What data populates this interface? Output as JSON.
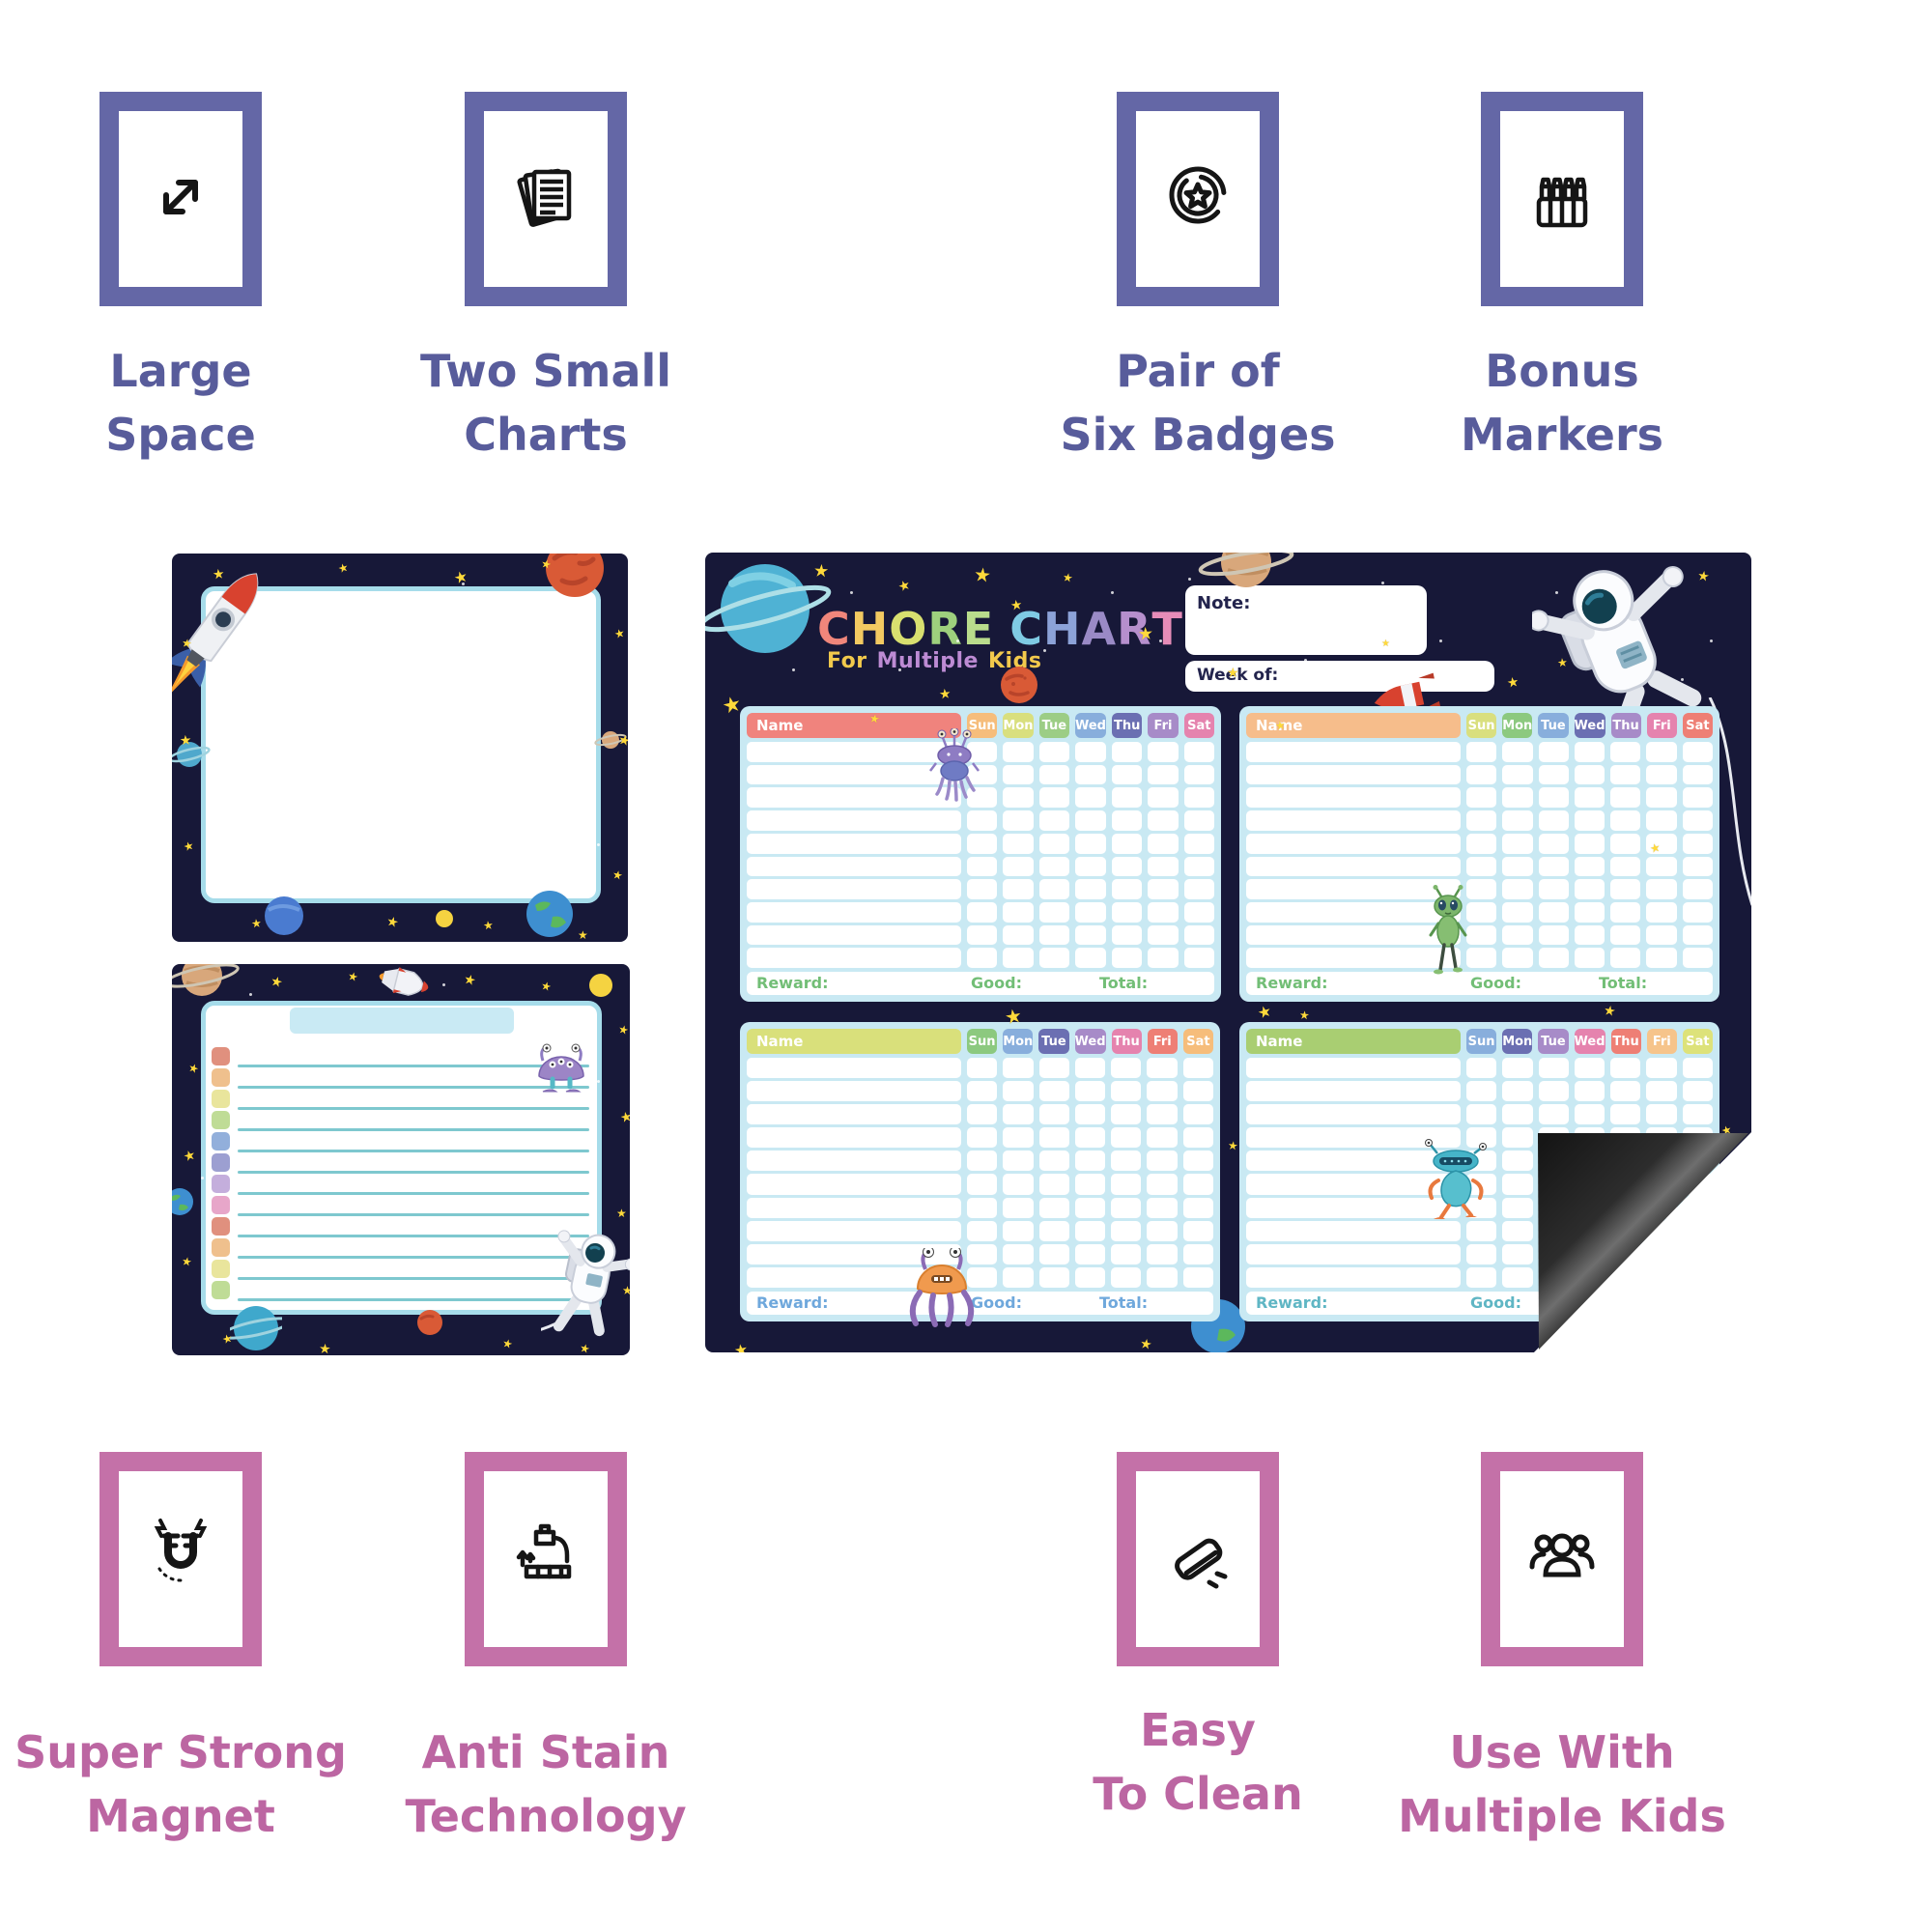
{
  "features_top": {
    "border_color": "#6467A6",
    "text_color": "#585C9B",
    "items": [
      {
        "icon": "expand-icon",
        "line1": "Large",
        "line2": "Space"
      },
      {
        "icon": "documents-icon",
        "line1": "Two Small",
        "line2": "Charts"
      },
      {
        "icon": "badge-icon",
        "line1": "Pair of",
        "line2": "Six Badges"
      },
      {
        "icon": "markers-icon",
        "line1": "Bonus",
        "line2": "Markers"
      }
    ]
  },
  "features_bottom": {
    "border_color": "#C471A8",
    "text_color": "#BC66A2",
    "items": [
      {
        "icon": "magnet-icon",
        "line1": "Super Strong",
        "line2": "Magnet"
      },
      {
        "icon": "faucet-icon",
        "line1": "Anti Stain",
        "line2": "Technology"
      },
      {
        "icon": "eraser-icon",
        "line1": "Easy",
        "line2": "To Clean"
      },
      {
        "icon": "people-icon",
        "line1": "Use With",
        "line2": "Multiple Kids"
      }
    ]
  },
  "chore_chart": {
    "title_letters": [
      {
        "ch": "C",
        "color": "#F0867B"
      },
      {
        "ch": "H",
        "color": "#F3C961"
      },
      {
        "ch": "O",
        "color": "#D8DF6F"
      },
      {
        "ch": "R",
        "color": "#9ED07D"
      },
      {
        "ch": "E",
        "color": "#B9DC8C"
      },
      {
        "ch": " ",
        "color": "#FFFFFF"
      },
      {
        "ch": "C",
        "color": "#7FCBE4"
      },
      {
        "ch": "H",
        "color": "#8CA2D8"
      },
      {
        "ch": "A",
        "color": "#9A8AC6"
      },
      {
        "ch": "R",
        "color": "#B68FCD"
      },
      {
        "ch": "T",
        "color": "#E68CB8"
      }
    ],
    "subtitle_words": [
      {
        "text": "For",
        "color": "#F2C94C"
      },
      {
        "text": "Multiple",
        "color": "#BD8BD4"
      },
      {
        "text": "Kids",
        "color": "#F2C94C"
      }
    ],
    "note_label": "Note:",
    "week_label": "Week of:",
    "days": [
      "Sun",
      "Mon",
      "Tue",
      "Wed",
      "Thu",
      "Fri",
      "Sat"
    ],
    "grids": [
      {
        "name_label": "Name",
        "name_color": "#F0837D",
        "day_colors": [
          "#F6BD7B",
          "#D9DF7E",
          "#9CCD85",
          "#88AEDC",
          "#6B6FB2",
          "#A78BC8",
          "#E583AE"
        ],
        "footer_labels": [
          "Reward:",
          "Good:",
          "Total:"
        ],
        "footer_color": "#72BE76",
        "alien": "purple-alien",
        "rows": 10
      },
      {
        "name_label": "Name",
        "name_color": "#F6BD8B",
        "day_colors": [
          "#D9DF7E",
          "#8CC97F",
          "#88AEDC",
          "#6B6FB2",
          "#A78BC8",
          "#E583AE",
          "#EE7F75"
        ],
        "footer_labels": [
          "Reward:",
          "Good:",
          "Total:"
        ],
        "footer_color": "#72BE76",
        "alien": "green-alien",
        "rows": 10
      },
      {
        "name_label": "Name",
        "name_color": "#D9E07B",
        "day_colors": [
          "#8CC97F",
          "#88AEDC",
          "#6B6FB2",
          "#A78BC8",
          "#E583AE",
          "#EE7F75",
          "#F6BD7B"
        ],
        "footer_labels": [
          "Reward:",
          "Good:",
          "Total:"
        ],
        "footer_color": "#6FA8DC",
        "alien": "orange-octopus-alien",
        "rows": 10
      },
      {
        "name_label": "Name",
        "name_color": "#A9CE72",
        "day_colors": [
          "#88AEDC",
          "#6B6FB2",
          "#A78BC8",
          "#E583AE",
          "#EE7F75",
          "#F6C48B",
          "#DDE27A"
        ],
        "footer_labels": [
          "Reward:",
          "Good:"
        ],
        "footer_color": "#5FB6C4",
        "alien": "teal-alien",
        "rows": 10
      }
    ]
  },
  "list_board": {
    "square_colors": [
      "#E0907E",
      "#EFC08D",
      "#E9E59C",
      "#BFDC96",
      "#92AFDB",
      "#9C9FD1",
      "#C4AEDC",
      "#E7A6C9",
      "#E0907E",
      "#EFC08D",
      "#E9E59C",
      "#BFDC96"
    ],
    "line_count": 12
  },
  "colors": {
    "navy": "#171838",
    "grid_bg": "#C9E9F3",
    "board_border": "#A6DCEA",
    "star_yellow": "#FFD93B",
    "magnet_back_black": "#1E1E1E",
    "accent_purple": "#6467A6",
    "accent_pink": "#C471A8"
  }
}
